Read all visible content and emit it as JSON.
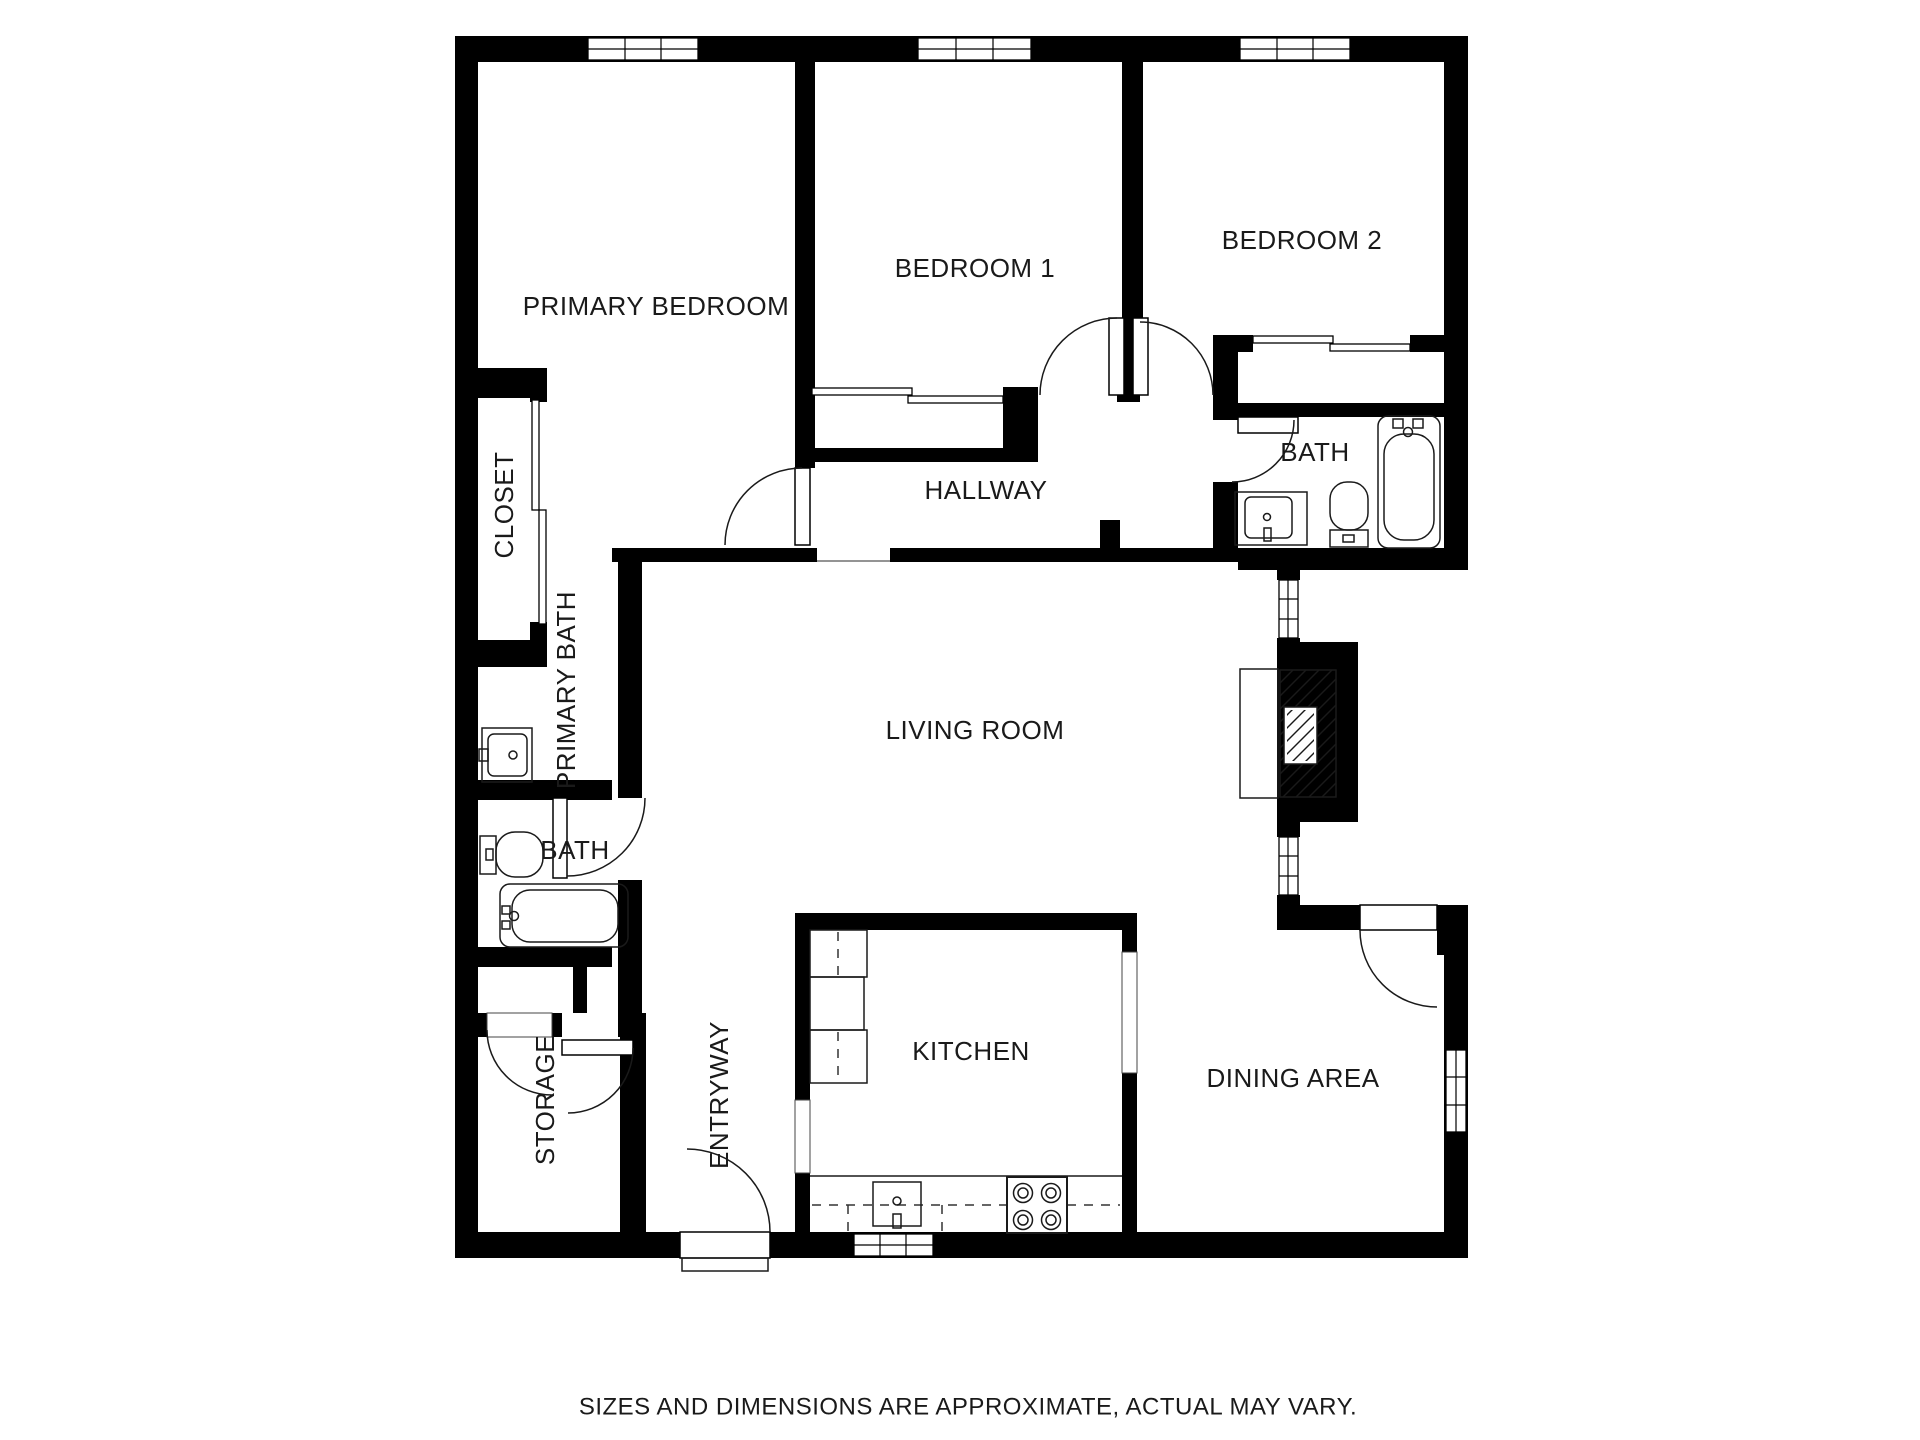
{
  "plan": {
    "rooms": [
      {
        "id": "primary-bedroom",
        "label": "PRIMARY BEDROOM"
      },
      {
        "id": "bedroom-1",
        "label": "BEDROOM 1"
      },
      {
        "id": "bedroom-2",
        "label": "BEDROOM 2"
      },
      {
        "id": "closet",
        "label": "CLOSET"
      },
      {
        "id": "hallway",
        "label": "HALLWAY"
      },
      {
        "id": "bath-upper",
        "label": "BATH"
      },
      {
        "id": "primary-bath",
        "label": "PRIMARY BATH"
      },
      {
        "id": "living-room",
        "label": "LIVING ROOM"
      },
      {
        "id": "bath-lower",
        "label": "BATH"
      },
      {
        "id": "storage",
        "label": "STORAGE"
      },
      {
        "id": "entryway",
        "label": "ENTRYWAY"
      },
      {
        "id": "kitchen",
        "label": "KITCHEN"
      },
      {
        "id": "dining-area",
        "label": "DINING AREA"
      }
    ],
    "footer": "SIZES AND DIMENSIONS ARE APPROXIMATE, ACTUAL MAY VARY.",
    "colors": {
      "wall": "#000000",
      "floor": "#ffffff",
      "line": "#1a1a1a"
    }
  }
}
